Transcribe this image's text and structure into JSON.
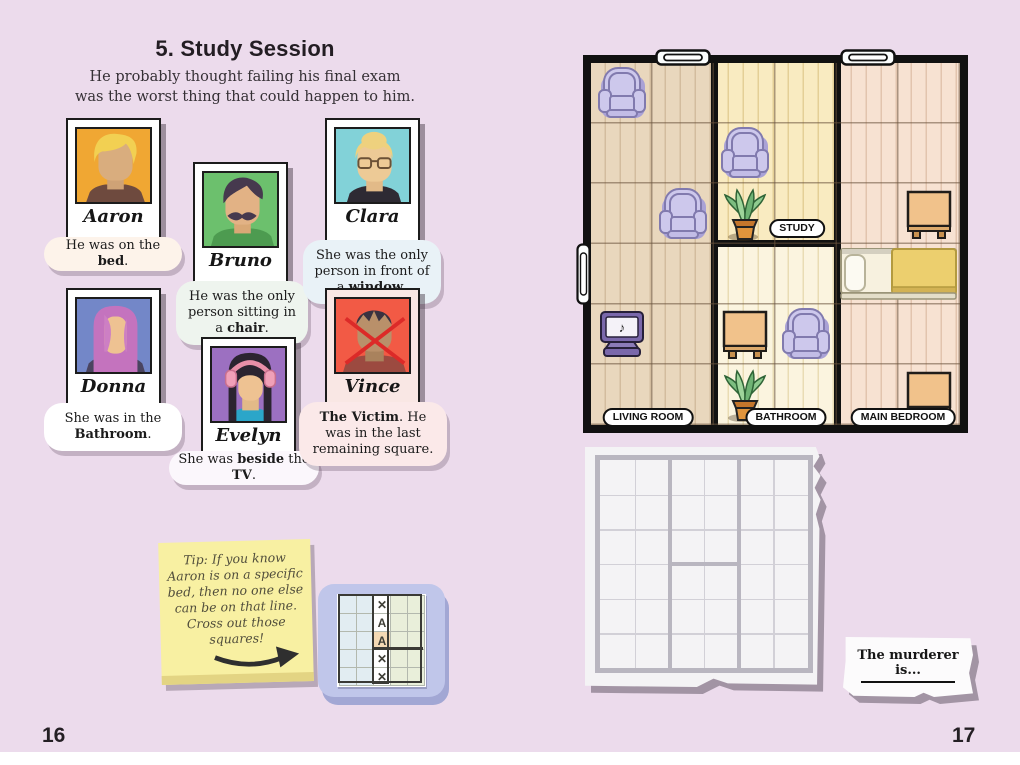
{
  "page": {
    "bg_color": "#ecdbec",
    "left_number": "16",
    "right_number": "17"
  },
  "header": {
    "title": "5. Study Session",
    "subtitle_line1": "He probably thought failing his final exam",
    "subtitle_line2": "was the worst thing that could happen to him."
  },
  "suspects": [
    {
      "name": "Aaron",
      "photo_bg": "#f0a733",
      "bubble_bg": "#fdf3ea",
      "clue": [
        {
          "t": "He was on the "
        },
        {
          "t": "bed",
          "b": true
        },
        {
          "t": "."
        }
      ]
    },
    {
      "name": "Bruno",
      "photo_bg": "#6cc06d",
      "bubble_bg": "#eef4ee",
      "clue": [
        {
          "t": "He was the only person sitting in a "
        },
        {
          "t": "chair",
          "b": true
        },
        {
          "t": "."
        }
      ]
    },
    {
      "name": "Clara",
      "photo_bg": "#82d2d8",
      "bubble_bg": "#e9f2f7",
      "clue": [
        {
          "t": "She was the only person in front of a "
        },
        {
          "t": "window",
          "b": true
        },
        {
          "t": "."
        }
      ]
    },
    {
      "name": "Donna",
      "photo_bg": "#7387c8",
      "bubble_bg": "#ffffff",
      "clue": [
        {
          "t": "She was in the "
        },
        {
          "t": "Bathroom",
          "b": true
        },
        {
          "t": "."
        }
      ]
    },
    {
      "name": "Evelyn",
      "photo_bg": "#9c70c1",
      "bubble_bg": "#fbf7fc",
      "clue": [
        {
          "t": "She was "
        },
        {
          "t": "beside",
          "b": true
        },
        {
          "t": " the "
        },
        {
          "t": "TV",
          "b": true
        },
        {
          "t": "."
        }
      ]
    },
    {
      "name": "Vince",
      "photo_bg": "#f25a45",
      "bubble_bg": "#fbe9e9",
      "card_bg": "#f9e7e4",
      "victim": true,
      "clue": [
        {
          "t": "The Victim",
          "b": true
        },
        {
          "t": ". He was in the last remaining square."
        }
      ]
    }
  ],
  "tip_note": {
    "lines": [
      "Tip: If you know",
      "Aaron is on a specific",
      "bed, then no one else",
      "can be on that line.",
      "Cross out those",
      "squares!"
    ]
  },
  "mini_grid": {
    "rows": 5,
    "cols": 5,
    "left_color": "#e2edf2",
    "mid_color": "#ffffff",
    "right_color": "#e9efda",
    "marks": [
      "x",
      "A",
      "A",
      "x",
      "x"
    ],
    "highlight_row": 2,
    "highlight_color": "#f4d9b4"
  },
  "floorplan": {
    "rooms": [
      {
        "id": "living-room",
        "label": "LIVING ROOM",
        "floor": "#e9d7bd",
        "plank": "#d3bc9e",
        "gx": 0,
        "gy": 0,
        "gw": 2,
        "gh": 6
      },
      {
        "id": "study",
        "label": "STUDY",
        "floor": "#f9ebc1",
        "plank": "#e4cf96",
        "gx": 2,
        "gy": 0,
        "gw": 2,
        "gh": 3
      },
      {
        "id": "bathroom",
        "label": "BATHROOM",
        "floor": "#fbf4df",
        "plank": "#e9dcb4",
        "gx": 2,
        "gy": 3,
        "gw": 2,
        "gh": 3
      },
      {
        "id": "main-bedroom",
        "label": "MAIN BEDROOM",
        "floor": "#f7e2d2",
        "plank": "#e2c4ae",
        "gx": 4,
        "gy": 0,
        "gw": 2,
        "gh": 6
      }
    ],
    "items": [
      {
        "type": "chair",
        "row": 1,
        "col": 1
      },
      {
        "type": "chair",
        "row": 3,
        "col": 2
      },
      {
        "type": "tv",
        "row": 5,
        "col": 1
      },
      {
        "type": "chair",
        "row": 2,
        "col": 3
      },
      {
        "type": "plant",
        "row": 3,
        "col": 3
      },
      {
        "type": "table",
        "row": 5,
        "col": 3
      },
      {
        "type": "chair",
        "row": 5,
        "col": 4
      },
      {
        "type": "plant",
        "row": 6,
        "col": 3
      },
      {
        "type": "table",
        "row": 3,
        "col": 6
      },
      {
        "type": "bed",
        "row": 4,
        "col": 5,
        "span": 2
      },
      {
        "type": "table",
        "row": 6,
        "col": 6
      },
      {
        "type": "window",
        "side": "top",
        "col": 2
      },
      {
        "type": "window",
        "side": "top",
        "col": 5
      },
      {
        "type": "door",
        "side": "left",
        "row": 4
      }
    ]
  },
  "answer_box": {
    "label": "The murderer is..."
  }
}
